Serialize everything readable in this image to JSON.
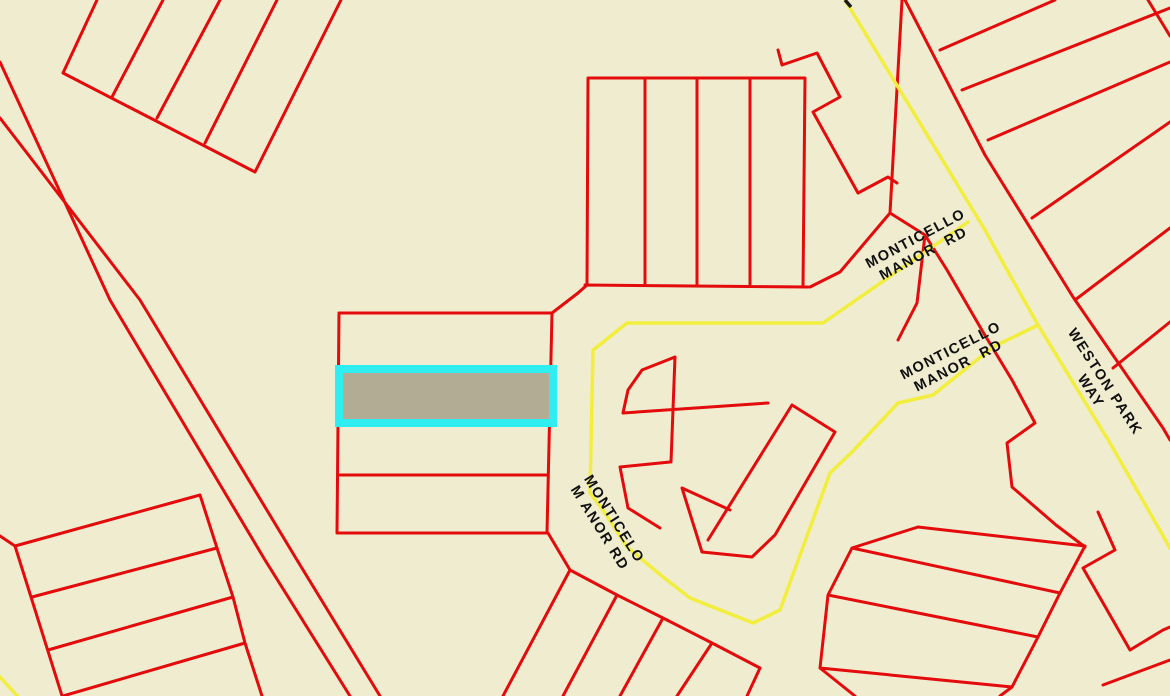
{
  "map": {
    "title": "Parcel map with highlighted lot on Monticello Manor Rd",
    "colors": {
      "background": "#f0ecd0",
      "parcel_line": "#e30b0b",
      "road_line": "#f2ee3e",
      "highlight_stroke": "#2eeef2",
      "highlight_fill": "#b2ac94",
      "label_text": "#101010",
      "tick_black": "#1a1a1a"
    },
    "labels": {
      "monticello_upper": {
        "line1": "MONTICELLO",
        "line2": "MANOR  RD"
      },
      "monticello_mid": {
        "line1": "MONTICELLO",
        "line2": "MANOR  RD"
      },
      "weston_park": {
        "line1": "WESTON PARK",
        "line2": "WAY"
      },
      "monticello_curved": {
        "line1": "MONTICELO",
        "line2": "M ANOR RD"
      }
    },
    "streets": [
      "MONTICELLO MANOR RD",
      "WESTON PARK WAY"
    ],
    "highlighted_parcel": {
      "status": "selected"
    }
  }
}
